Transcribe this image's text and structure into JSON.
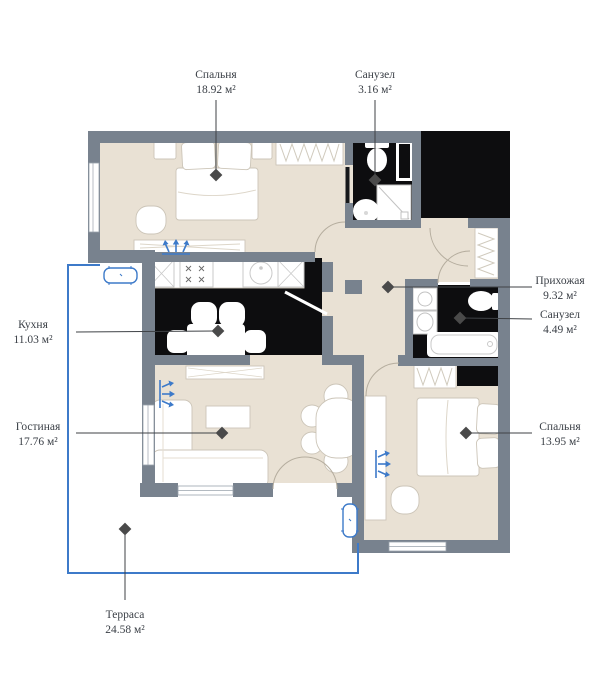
{
  "plan_title": "apartment-floor-plan",
  "rooms": [
    {
      "id": "bedroom-1",
      "name": "Спальня",
      "area": "18.92 м²"
    },
    {
      "id": "bathroom-1",
      "name": "Санузел",
      "area": "3.16 м²"
    },
    {
      "id": "hallway",
      "name": "Прихожая",
      "area": "9.32 м²"
    },
    {
      "id": "bathroom-2",
      "name": "Санузел",
      "area": "4.49 м²"
    },
    {
      "id": "bedroom-2",
      "name": "Спальня",
      "area": "13.95 м²"
    },
    {
      "id": "kitchen",
      "name": "Кухня",
      "area": "11.03 м²"
    },
    {
      "id": "living-room",
      "name": "Гостиная",
      "area": "17.76 м²"
    },
    {
      "id": "terrace",
      "name": "Терраса",
      "area": "24.58 м²"
    }
  ],
  "colors": {
    "wall": "#78828E",
    "floor": "#E9E1D4",
    "wet_zone": "#0D0D0F",
    "terrace_accent": "#3D7AC9",
    "leader": "#3F4246",
    "text": "#3A3F46"
  }
}
